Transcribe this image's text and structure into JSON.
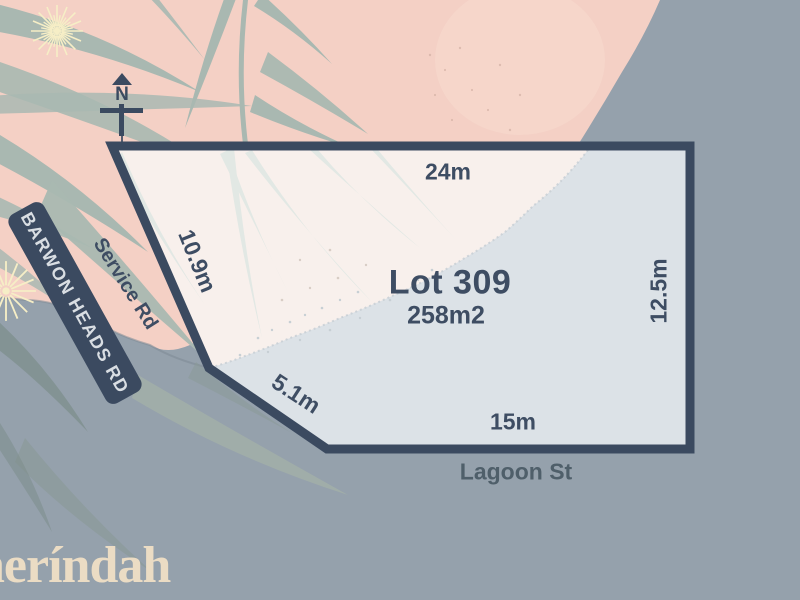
{
  "plan": {
    "lot": {
      "title": "Lot 309",
      "area": "258m2"
    },
    "dimensions": {
      "top": "24m",
      "right": "12.5m",
      "bottom": "15m",
      "lower_left_diagonal": "5.1m",
      "upper_left": "10.9m"
    },
    "roads": {
      "main": "BARWON HEADS RD",
      "service": "Service Rd",
      "bottom": "Lagoon St"
    },
    "compass": {
      "north": "N"
    },
    "branding": {
      "logo": "neríndah"
    },
    "colors": {
      "background_gray": "#95a1ac",
      "terrain_pink": "#f4d0c5",
      "boundary_navy": "#3b4a60",
      "lot_fill_light": "#f8f0ec",
      "lot_fill_shaded": "#dce2e7",
      "foliage_green": "#a9b8b1",
      "label_navy": "#3e4d63",
      "logo_cream": "#ebdcc4",
      "blossom_cream": "#f6eec6"
    }
  }
}
